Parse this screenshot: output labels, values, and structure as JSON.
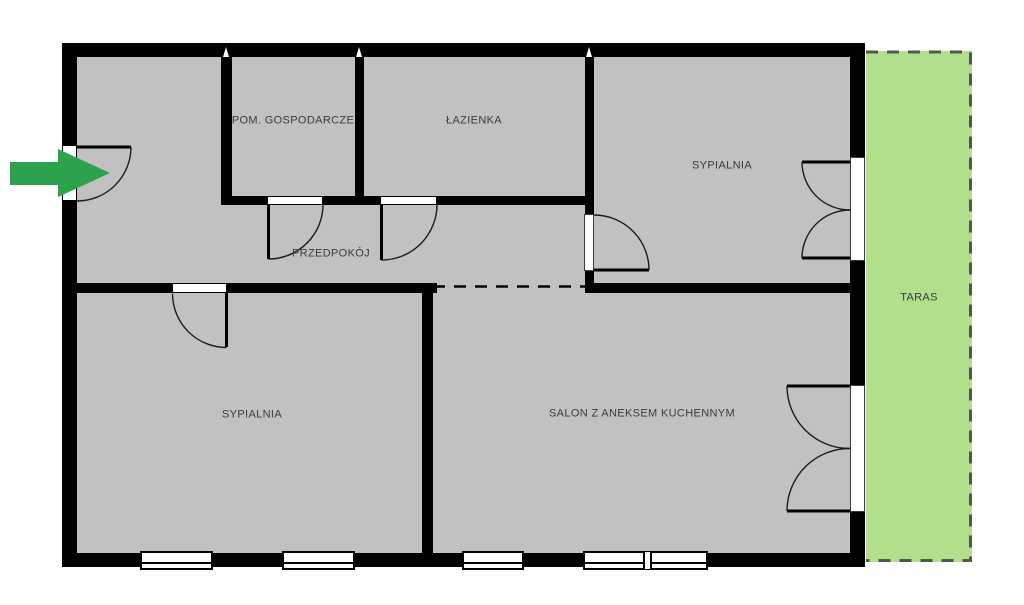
{
  "floorplan": {
    "rooms": {
      "utility": {
        "label": "POM. GOSPODARCZE"
      },
      "bathroom": {
        "label": "ŁAZIENKA"
      },
      "bedroom_top": {
        "label": "SYPIALNIA"
      },
      "hallway": {
        "label": "PRZEDPOKÓJ"
      },
      "bedroom_bottom": {
        "label": "SYPIALNIA"
      },
      "living_room": {
        "label": "SALON Z ANEKSEM KUCHENNYM"
      },
      "terrace": {
        "label": "TARAS"
      }
    },
    "entrance": {
      "icon": "green-arrow-right",
      "direction": "right"
    },
    "symbols": {
      "interior_doors": 5,
      "french_double_doors": 2,
      "windows": 4,
      "open_boundary": "dashed line between hallway and living room",
      "terrace_boundary": "dashed green border"
    },
    "colors": {
      "wall": "#000000",
      "room_fill": "#c1c1c1",
      "terrace_fill": "#b1df8b",
      "terrace_border": "#4e5a43",
      "arrow": "#2da24c",
      "label_text": "#3b3b3b",
      "background": "#ffffff"
    }
  }
}
